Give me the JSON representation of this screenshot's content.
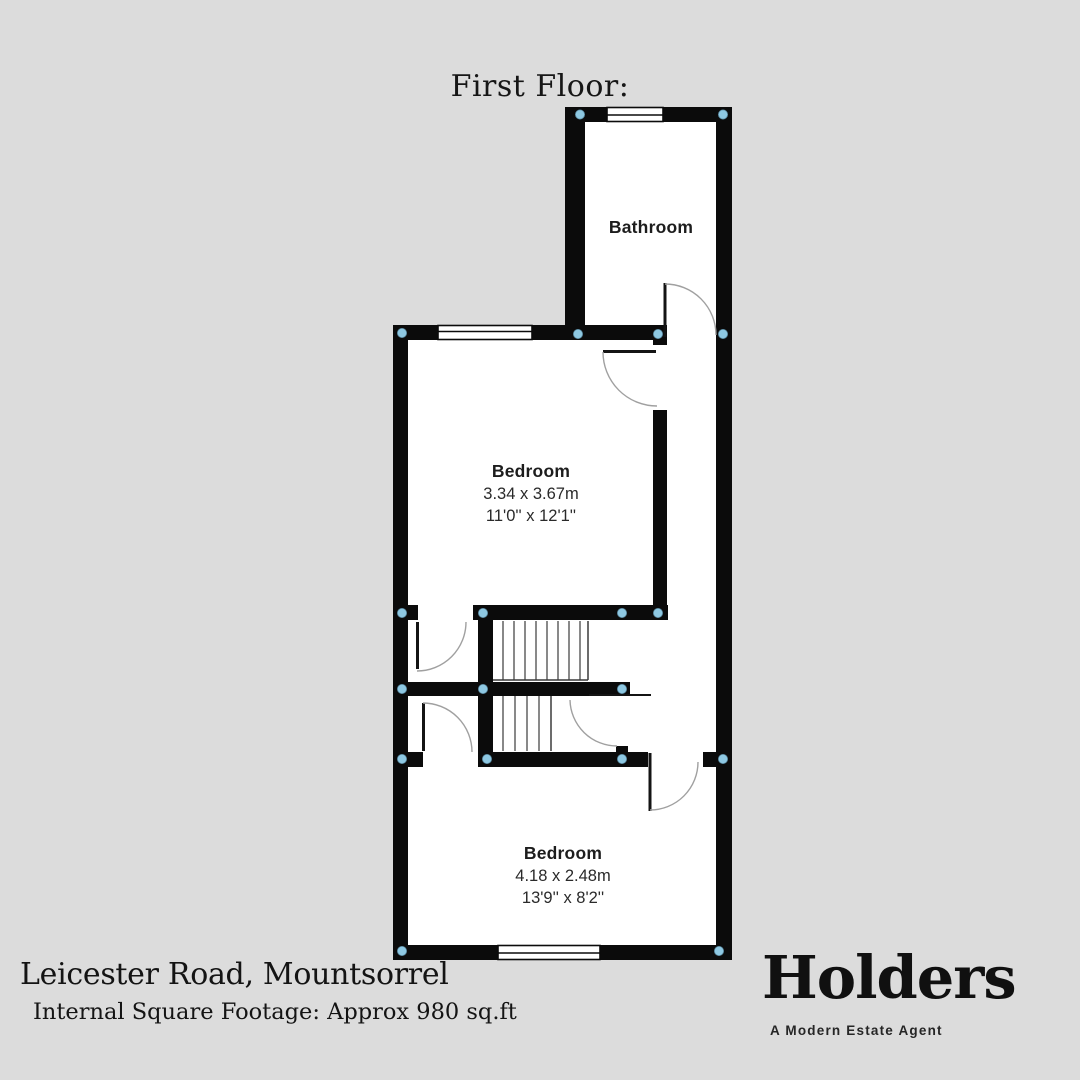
{
  "page": {
    "title": "First Floor:"
  },
  "floor_plan": {
    "rooms": [
      {
        "name": "Bathroom"
      },
      {
        "name": "Bedroom",
        "size_metric": "3.34 x 3.67m",
        "size_imperial": "11'0'' x 12'1''"
      },
      {
        "name": "Bedroom",
        "size_metric": "4.18 x 2.48m",
        "size_imperial": "13'9'' x 8'2''"
      }
    ],
    "wall_color": "#0b0b0b",
    "room_fill_color": "#ffffff",
    "junction_marker_color": "#8ec8e2",
    "door_arc_color": "#a0a0a0",
    "background_color": "#dcdcdc"
  },
  "footer": {
    "address": "Leicester Road, Mountsorrel",
    "square_footage": "Internal Square Footage: Approx 980 sq.ft"
  },
  "brand": {
    "name": "Holders",
    "tagline": "A Modern Estate Agent"
  }
}
